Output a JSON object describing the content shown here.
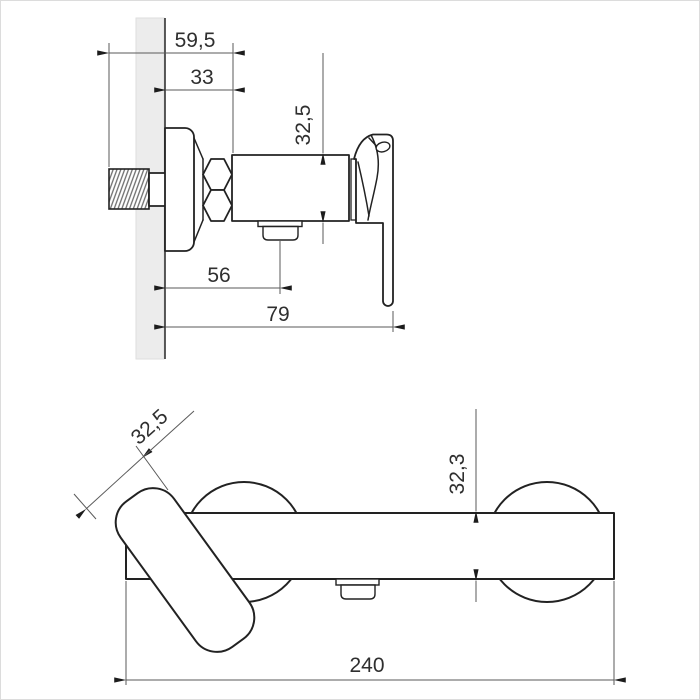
{
  "drawing": {
    "title": "wall-mounted-mixer-dimension-drawing",
    "colors": {
      "background": "#ffffff",
      "object_line": "#222222",
      "dimension_line": "#5a5a5a",
      "wall_fill": "#ececec",
      "text": "#2f2f2f",
      "border": "#dcdcdc"
    },
    "side_view": {
      "name": "side-view-top",
      "dimensions": {
        "tail_depth": "59,5",
        "wall_to_body": "33",
        "body_height": "32,5",
        "wall_to_outlet": "56",
        "wall_to_handle_end": "79"
      }
    },
    "front_view": {
      "name": "front-view-bottom",
      "dimensions": {
        "handle_diameter": "32,5",
        "body_height": "32,3",
        "overall_width": "240"
      }
    }
  }
}
